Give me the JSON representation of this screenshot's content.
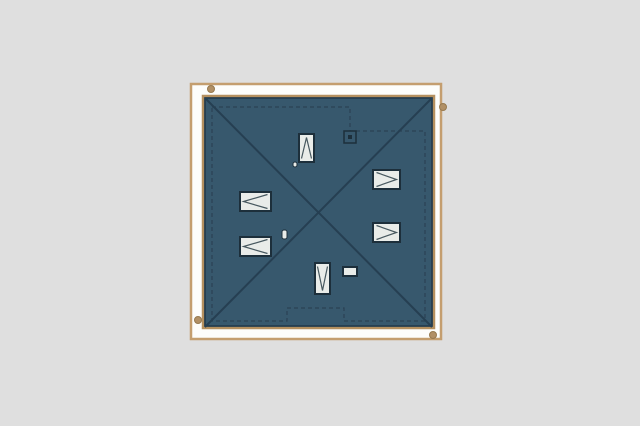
{
  "scene": {
    "kind": "architectural-roof-plan",
    "canvas": {
      "width": 640,
      "height": 426
    },
    "colors": {
      "background": "#dfdfdf",
      "paper_fill": "#fdfdfb",
      "frame": "#c49e6f",
      "roof_fill": "#37586d",
      "roof_edge_tan": "#b5905f",
      "roof_edge_dark": "#22384a",
      "ridge": "#263f52",
      "wall_dash": "#2b4254",
      "window_fill": "#e9ece9",
      "window_border": "#1d2f3b",
      "window_glyph": "#47585f",
      "dot_fill": "#b19066",
      "dot_edge": "#96794f"
    },
    "paper_frame": {
      "x": 191,
      "y": 84,
      "w": 250,
      "h": 255,
      "border_width": 2.5
    },
    "roof": {
      "x": 203,
      "y": 96,
      "w": 231,
      "h": 232
    },
    "ridges": [
      {
        "x1": 205,
        "y1": 98,
        "x2": 432,
        "y2": 327
      },
      {
        "x1": 432,
        "y1": 98,
        "x2": 205,
        "y2": 327
      }
    ],
    "wall_outline": {
      "path": "M 212 107 L 350 107 L 350 131 L 425 131 L 425 321 L 344 321 L 344 308 L 287 308 L 287 321 L 212 321 Z",
      "dash": "4 3"
    },
    "skylights": [
      {
        "name": "skylight-north",
        "x": 299,
        "y": 134,
        "w": 15,
        "h": 28,
        "dir": "up"
      },
      {
        "name": "skylight-west-upper",
        "x": 240,
        "y": 192,
        "w": 31,
        "h": 19,
        "dir": "left"
      },
      {
        "name": "skylight-west-lower",
        "x": 240,
        "y": 237,
        "w": 31,
        "h": 19,
        "dir": "left"
      },
      {
        "name": "skylight-east-upper",
        "x": 373,
        "y": 170,
        "w": 27,
        "h": 19,
        "dir": "right"
      },
      {
        "name": "skylight-east-lower",
        "x": 373,
        "y": 223,
        "w": 27,
        "h": 19,
        "dir": "right"
      },
      {
        "name": "skylight-south",
        "x": 315,
        "y": 263,
        "w": 15,
        "h": 31,
        "dir": "down"
      },
      {
        "name": "roof-hatch",
        "x": 343,
        "y": 267,
        "w": 14,
        "h": 9,
        "dir": "none"
      }
    ],
    "chimney": {
      "x": 344,
      "y": 131,
      "w": 12,
      "h": 12,
      "dot_size": 4
    },
    "vents": [
      {
        "name": "vent-pipe-small",
        "x": 293,
        "y": 162,
        "w": 4,
        "h": 5
      },
      {
        "name": "vent-pipe",
        "x": 282,
        "y": 230,
        "w": 5,
        "h": 9
      }
    ],
    "survey_dots": {
      "r": 3.5,
      "points": [
        {
          "cx": 211,
          "cy": 89
        },
        {
          "cx": 443,
          "cy": 107
        },
        {
          "cx": 198,
          "cy": 320
        },
        {
          "cx": 433,
          "cy": 335
        }
      ]
    }
  }
}
